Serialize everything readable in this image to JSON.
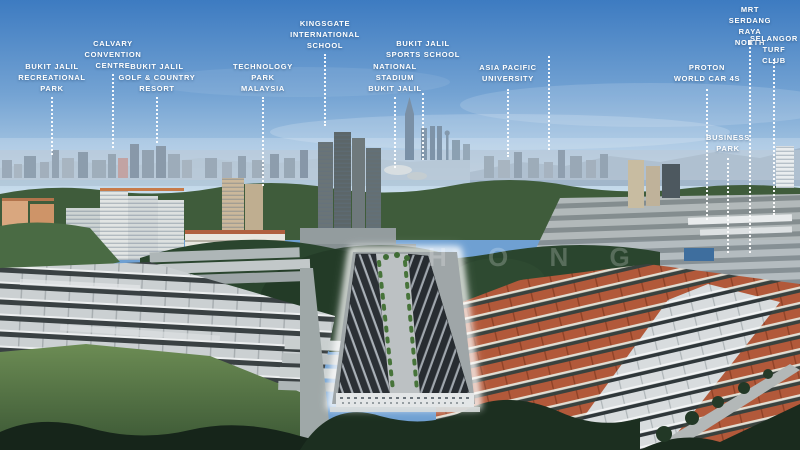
{
  "watermark": "H O N G",
  "colors": {
    "sky_top": "#3D7BC1",
    "sky_horizon": "#D9E7F1",
    "label_text": "#FFFFFF",
    "leader_line": "#FFFFFF",
    "site_glow": "#FFFFFF",
    "forest_green": "#2A452E",
    "red_roofs": "#B2593A",
    "grey_roofs": "#CBD0D2"
  },
  "landmarks": [
    {
      "name": "bukit-jalil-recreational-park",
      "label": "BUKIT JALIL\nRECREATIONAL\nPARK",
      "x": 52,
      "label_top": 61,
      "line_start": 97,
      "line_end": 155
    },
    {
      "name": "calvary-convention-centre",
      "label": "CALVARY\nCONVENTION\nCENTRE",
      "x": 113,
      "label_top": 38,
      "line_start": 74,
      "line_end": 148
    },
    {
      "name": "bukit-jalil-golf-country-resort",
      "label": "BUKIT JALIL\nGOLF & COUNTRY\nRESORT",
      "x": 157,
      "label_top": 61,
      "line_start": 97,
      "line_end": 143
    },
    {
      "name": "technology-park-malaysia",
      "label": "TECHNOLOGY\nPARK\nMALAYSIA",
      "x": 263,
      "label_top": 61,
      "line_start": 97,
      "line_end": 186
    },
    {
      "name": "kingsgate-international-school",
      "label": "KINGSGATE\nINTERNATIONAL\nSCHOOL",
      "x": 325,
      "label_top": 18,
      "line_start": 54,
      "line_end": 126
    },
    {
      "name": "national-stadium-bukit-jalil",
      "label": "NATIONAL\nSTADIUM\nBUKIT JALIL",
      "x": 395,
      "label_top": 61,
      "line_start": 97,
      "line_end": 168
    },
    {
      "name": "bukit-jalil-sports-school",
      "label": "BUKIT JALIL\nSPORTS SCHOOL",
      "x": 423,
      "label_top": 38,
      "line_start": 93,
      "line_end": 160
    },
    {
      "name": "asia-pacific-university",
      "label": "ASIA PACIFIC\nUNIVERSITY",
      "x": 508,
      "label_top": 62,
      "line_start": 89,
      "line_end": 157
    },
    {
      "name": "city-skyline-pointer",
      "label": "",
      "x": 549,
      "label_top": 0,
      "line_start": 56,
      "line_end": 150
    },
    {
      "name": "proton-world-car-4s",
      "label": "PROTON\nWORLD CAR 4S",
      "x": 707,
      "label_top": 62,
      "line_start": 89,
      "line_end": 220
    },
    {
      "name": "mrt-serdang-raya-north",
      "label": "MRT\nSERDANG\nRAYA NORTH",
      "x": 750,
      "label_top": 4,
      "line_start": 40,
      "line_end": 253
    },
    {
      "name": "selangor-turf-club",
      "label": "SELANGOR\nTURF CLUB",
      "x": 774,
      "label_top": 33,
      "line_start": 59,
      "line_end": 215
    },
    {
      "name": "business-park",
      "label": "BUSINESS\nPARK",
      "x": 728,
      "label_top": 132,
      "line_start": 158,
      "line_end": 253
    }
  ]
}
